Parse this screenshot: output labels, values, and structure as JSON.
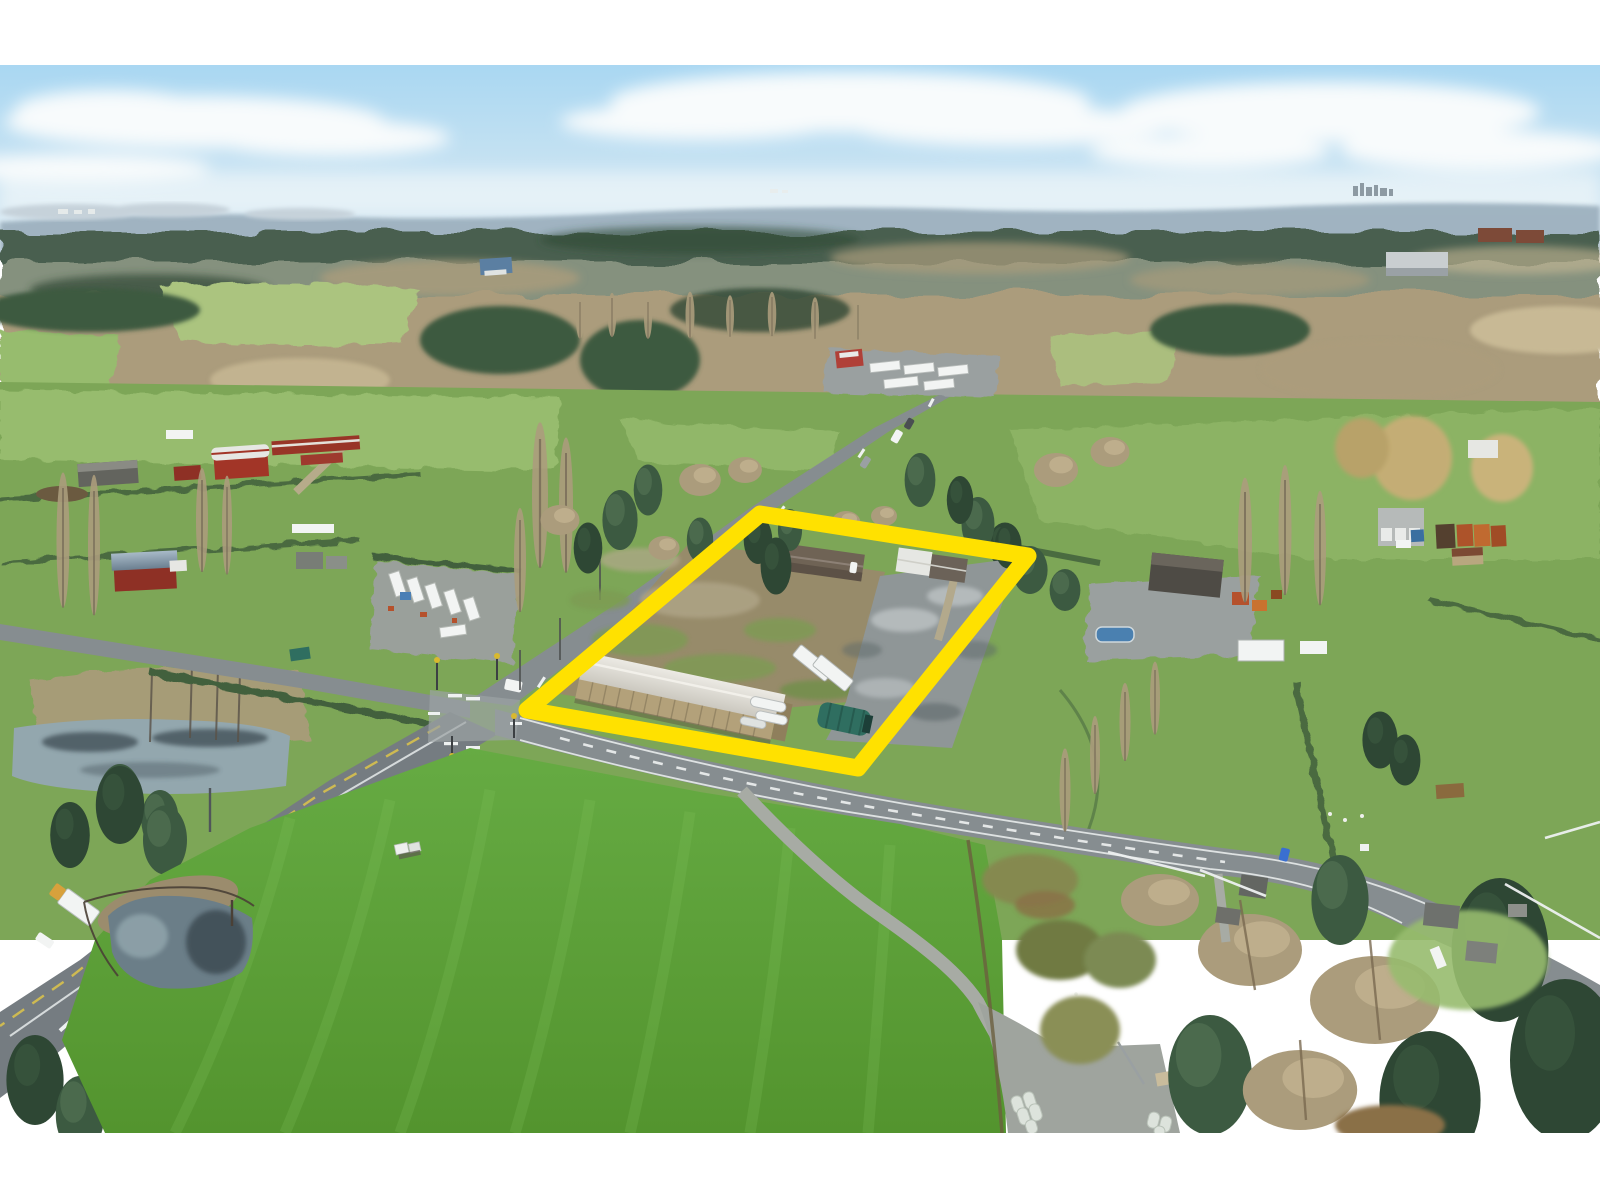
{
  "scene": {
    "type": "aerial-drone-photograph",
    "description": "Aerial drone photo of a rural real-estate listing: a thick yellow outline highlights a parcel at a country crossroads containing a long tan storage warehouse with a pale gable roof, two houses, white semi trailers, a green tarp shelter, a cleared dirt field and a grey gravel yard. Around it are farmland with red barns, a mobile-home park, pastures with hedgerows, orange shipping containers, winding rural roads with a box truck, two ponds, a vivid green foreground hay field with a farm track and wrapped bales, bare winter trees, evergreen forest, a hazy blue ridge and a soft cloudy sky.",
    "season": "winter - bare deciduous trees, bright overcast sky",
    "photo_top_offset_px": 65,
    "photo_bottom_px": 1133
  },
  "property_outline": {
    "color": "#ffe100",
    "shape": "perspective-rotated rectangle",
    "corner_points": "760,514 1028,556 858,768 527,710",
    "stroke_width_px": 17,
    "contains": [
      "long storage warehouse, tan walls, light grey gable roof",
      "two houses with driveway",
      "white storage trailers",
      "tanker/semi trailers",
      "dark green tarp quonset shelter",
      "cleared dirt field",
      "grey gravel yard with puddles"
    ]
  },
  "landmarks": [
    {
      "name": "property-boundary-outline",
      "label": "yellow highlighted parcel"
    },
    {
      "name": "warehouse",
      "label": "long tan storage building inside parcel"
    },
    {
      "name": "intersection",
      "label": "signalized rural crossroads west of parcel"
    },
    {
      "name": "highway",
      "label": "two-lane highway running to lower-left with white box truck"
    },
    {
      "name": "cross-road",
      "label": "road running along the front of the parcel"
    },
    {
      "name": "red-barn-farm",
      "label": "farm with red gambrel barn on the left"
    },
    {
      "name": "mobile-home-park",
      "label": "cluster of mobile homes left of the road"
    },
    {
      "name": "shipping-containers",
      "label": "orange containers by grey garage at right edge"
    },
    {
      "name": "foreground-field",
      "label": "bright green hay field with pond, farm track and wrapped bales"
    },
    {
      "name": "north-pond",
      "label": "marshy pond at left edge"
    },
    {
      "name": "distant-ridge",
      "label": "hazy blue mountain ridge with tiny city skyline"
    }
  ],
  "palette": {
    "sky_top": "#a9d7f2",
    "sky_low": "#e0ecf3",
    "cloud": "#f8fbfc",
    "ridge": "#9db1bf",
    "ridge_light": "#c6d2da",
    "skyline": "#8d9aa3",
    "far_conifer": "#4a5f50",
    "far_mix": "#8c9784",
    "bare": "#ab9c7c",
    "bare_hi": "#c8b995",
    "conifer": "#3c5a41",
    "conifer_hi": "#5d7f5d",
    "conifer_dark": "#2e4734",
    "hedge": "#42613d",
    "trunk": "#6e6352",
    "field_green": "#7da657",
    "field_light": "#97bc6e",
    "field_pale": "#abc47f",
    "grass_top": "#66ab43",
    "grass_bottom": "#53942e",
    "grass_stripe": "#83c45e",
    "road_grey": "#868d90",
    "road_light": "#9ba2a4",
    "highway_grey": "#757c81",
    "marking_white": "#eef1f1",
    "yellow_line": "#d8c14d",
    "dirt": "#978b6a",
    "gravel": "#8f9697",
    "gravel_light": "#b4babb",
    "gravel_dark": "#5e676a",
    "roof_white": "#e6e7e3",
    "roof_brown": "#6f6355",
    "wall_tan": "#b3a17a",
    "wall_tan_dark": "#8f7f5c",
    "barn_red": "#a23527",
    "barn_red_dark": "#8e3025",
    "metal_roof": "#8ea2b2",
    "teal_tarp": "#2f6e60",
    "water": "#6b7e88",
    "water_dark": "#3e4c53",
    "water_light": "#93a7ae",
    "outline_yellow": "#ffe100",
    "truck_white": "#f2f4f3",
    "truck_cab": "#d8a13c",
    "container_orange": "#b5571f",
    "container_blue": "#3a6fa0",
    "pool_blue": "#4a80b0",
    "bale_white": "#dde3dc",
    "scrub_olive": "#85894f",
    "frame_white": "#ffffff"
  }
}
